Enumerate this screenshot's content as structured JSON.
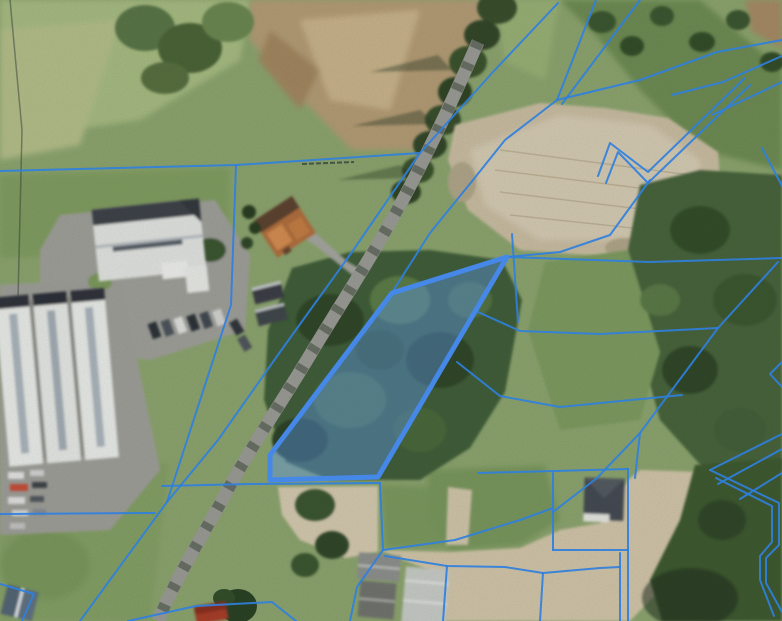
{
  "app": {
    "name": "aerial-cadastral-map-viewer"
  },
  "map": {
    "view": "orthophoto-with-cadastral-overlay",
    "size": {
      "width": 782,
      "height": 621
    },
    "colors": {
      "boundary_line": "#2f7fdd",
      "highlight_stroke": "#4588e8",
      "highlight_fill": "#5b93e8"
    },
    "highlight_parcel": {
      "points": "507,257 378,477 270,480 270,455 392,293",
      "fill_opacity": 0.42,
      "stroke_width": 5
    },
    "boundary_lines": [
      "0,171 236,165 420,153",
      "236,165 231,305 167,502",
      "420,153 352,252 280,352 218,440 167,502 80,621",
      "558,3 493,72 420,153",
      "557,100 505,140 473,180 430,233 393,291",
      "557,100 596,0",
      "562,104 640,0",
      "557,100 640,80 717,52 782,40",
      "672,95 723,82 782,56",
      "712,115 782,82",
      "762,148 782,186",
      "598,176 610,143 648,172 745,78",
      "606,183 618,152 648,183 750,85",
      "650,180 610,235 560,252 507,257",
      "512,234 518,322",
      "507,257 650,262 782,258",
      "778,262 718,328 640,433 597,478 553,512",
      "478,312 520,331 600,334 718,328",
      "457,362 500,396 560,407 682,395",
      "640,433 635,478",
      "478,473 628,469",
      "553,473 553,550",
      "553,550 628,550",
      "628,469 628,621",
      "620,553 620,621",
      "543,573 600,568 620,567",
      "710,470 782,434",
      "718,484 782,449",
      "740,499 782,473",
      "710,470 779,503 779,545 766,558 766,583 782,612",
      "716,478 772,506 772,542 760,556 760,580 774,616",
      "162,486 250,484 380,483",
      "380,483 383,550",
      "383,550 455,540 520,520 553,508",
      "385,556 447,566 505,567 543,573",
      "383,550 357,587 350,621",
      "447,566 443,621",
      "543,573 540,621",
      "0,514 155,513",
      "0,584 34,594 22,621",
      "128,621 196,606 272,602 296,621",
      "782,362 770,374 782,387"
    ]
  }
}
